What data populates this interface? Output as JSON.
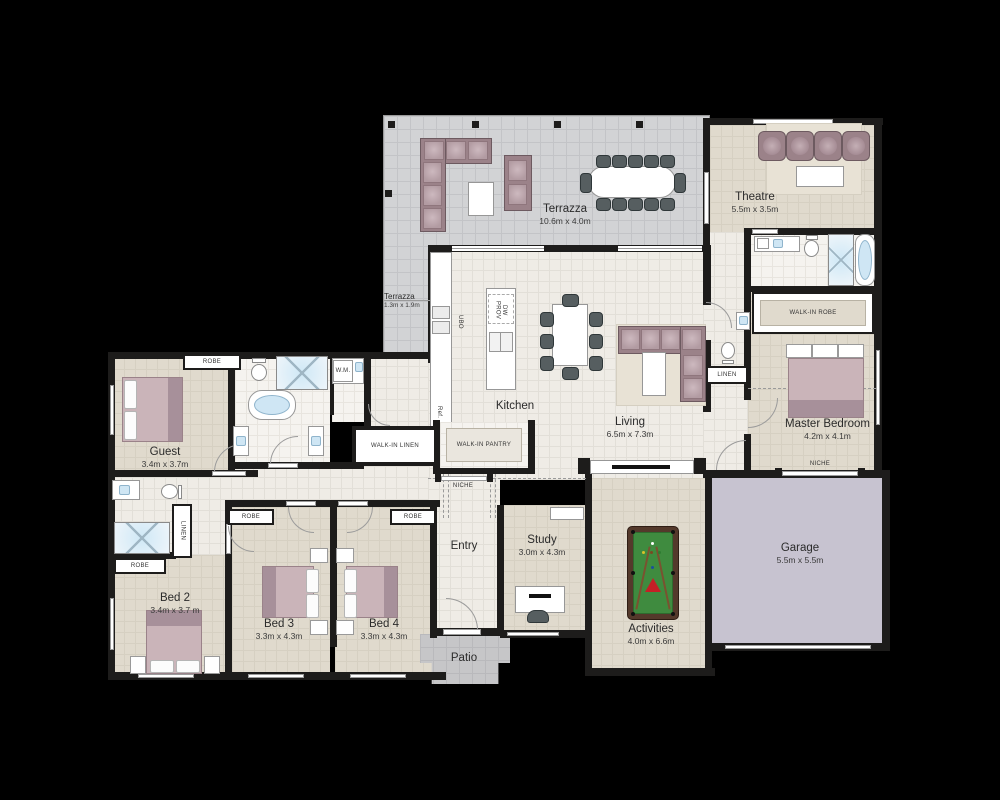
{
  "rooms": {
    "terrazza_main": {
      "name": "Terrazza",
      "dims": "10.6m x 4.0m"
    },
    "terrazza_small": {
      "name": "Terrazza",
      "dims": "1.3m x 1.9m"
    },
    "theatre": {
      "name": "Theatre",
      "dims": "5.5m x 3.5m"
    },
    "kitchen": {
      "name": "Kitchen"
    },
    "living": {
      "name": "Living",
      "dims": "6.5m x 7.3m"
    },
    "master_bedroom": {
      "name": "Master Bedroom",
      "dims": "4.2m x 4.1m"
    },
    "guest": {
      "name": "Guest",
      "dims": "3.4m x 3.7m"
    },
    "bed2": {
      "name": "Bed 2",
      "dims": "3.4m x 3.7 m"
    },
    "bed3": {
      "name": "Bed 3",
      "dims": "3.3m x 4.3m"
    },
    "bed4": {
      "name": "Bed 4",
      "dims": "3.3m x 4.3m"
    },
    "study": {
      "name": "Study",
      "dims": "3.0m x 4.3m"
    },
    "activities": {
      "name": "Activities",
      "dims": "4.0m x 6.6m"
    },
    "garage": {
      "name": "Garage",
      "dims": "5.5m x 5.5m"
    },
    "entry": {
      "name": "Entry"
    },
    "patio": {
      "name": "Patio"
    }
  },
  "labels": {
    "walk_in_robe": "WALK-IN ROBE",
    "walk_in_pantry": "WALK-IN PANTRY",
    "walk_in_linen": "WALK-IN LINEN",
    "robe": "ROBE",
    "linen": "LINEN",
    "niche": "NICHE",
    "wm": "W.M.",
    "ubo": "UBO",
    "ref": "Ref.",
    "dw_prov": "DW PROV"
  },
  "colors": {
    "wall": "#1d1c1b",
    "terrace_floor": "#d2d3d5",
    "interior_floor": "#efece6",
    "room_floor": "#e0dacd",
    "garage_floor": "#c7c3d0",
    "patio_floor": "#c6c6c8",
    "sofa": "#9b8289",
    "bed": "#cab4b9",
    "pool_table_green": "#3f8b3f",
    "fixture_blue": "#cfe6f4"
  }
}
